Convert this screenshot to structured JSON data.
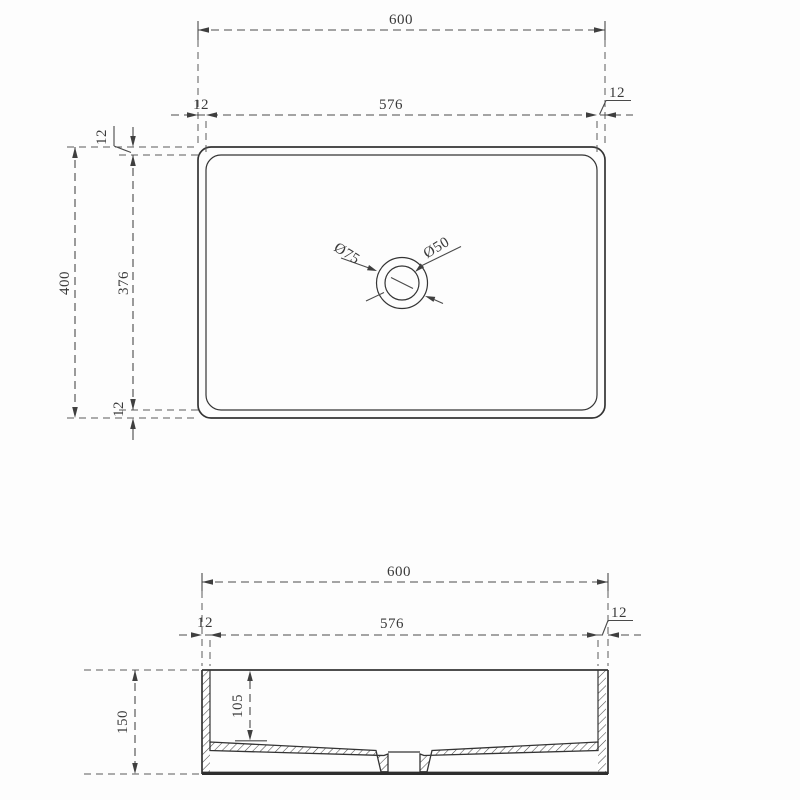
{
  "drawing_title": "rectangular-basin-technical-drawing",
  "colors": {
    "line": "#343434",
    "dimension": "#4a4a4a",
    "background": "#fdfdfd"
  },
  "top_view": {
    "width_overall": "600",
    "width_inner": "576",
    "wall_left": "12",
    "wall_right": "12",
    "height_overall": "400",
    "height_inner": "376",
    "wall_top": "12",
    "wall_bottom": "12",
    "drain_outer_diameter": "Ø75",
    "drain_inner_diameter": "Ø50"
  },
  "section_view": {
    "width_overall": "600",
    "width_inner": "576",
    "wall_left": "12",
    "wall_right": "12",
    "height_overall": "150",
    "depth_inner": "105"
  }
}
